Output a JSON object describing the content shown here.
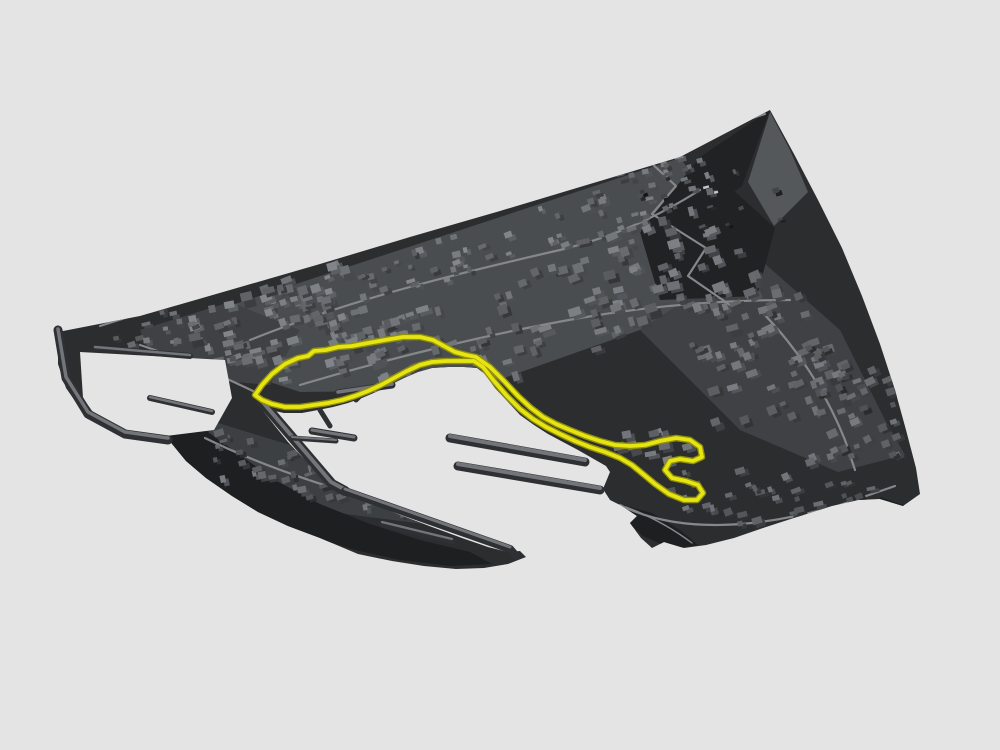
{
  "scene": {
    "description": "3D rendered city map of Monaco with the Grand Prix street circuit highlighted in yellow around Port Hercule",
    "map_name": "monaco-3d-map",
    "track_name": "f1-circuit-track"
  },
  "colors": {
    "background": "#e3e4e3",
    "terrain_base": "#2b2d2f",
    "terrain_shadow": "#1d1f21",
    "plateau": "#4a4d50",
    "plateau_dark": "#3f4144",
    "rock_plateau": "#3d4043",
    "building_top": "#6f7174",
    "building_side": "#46484b",
    "road": "#85878a",
    "pier_top": "#73757a",
    "pier_side": "#2e3033",
    "track": "#e6e412",
    "track_casing": "#91900a",
    "facet_light": "#55585b",
    "facet_dark": "#202224",
    "glint": "#c3c6c8"
  }
}
